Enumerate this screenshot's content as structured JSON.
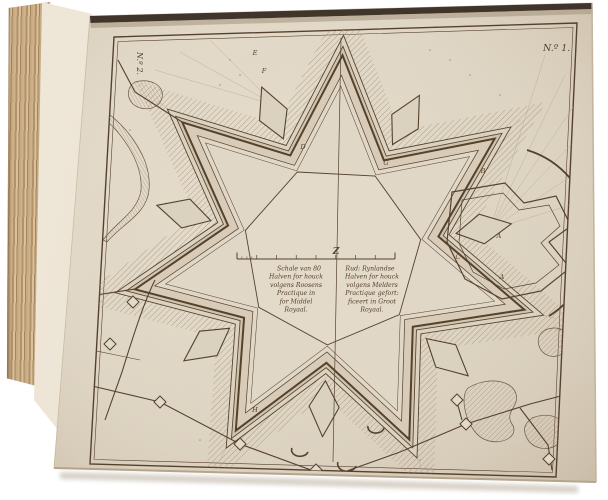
{
  "scene": {
    "description": "Photograph of an antique book opened to a fold-out engraved plate with a star-fortress plan",
    "background_color": "#ffffff"
  },
  "book": {
    "fore_edge_color": "#bfa077",
    "paper_color": "#ddd3c2",
    "ink_color": "#55422e"
  },
  "plate": {
    "number_label": "N.º 1.",
    "underlying_plate_number_label": "N.º 2.",
    "meridian_mark": "Z",
    "caption": {
      "left_lines": [
        "Schale van 80",
        "Halven for houck",
        "volgens Roosens",
        "Practique in",
        "for Middel",
        "Royaal."
      ],
      "right_lines": [
        "Rud: Rynlandse",
        "Halven for houck",
        "volgens Melders",
        "Practique gefort:",
        "ficeert in Groot",
        "Royaal."
      ]
    },
    "labels": {
      "e": "E",
      "f": "F",
      "d": "D",
      "g": "G",
      "b": "B",
      "a1": "A",
      "c": "C",
      "a2": "A",
      "h": "H"
    }
  }
}
